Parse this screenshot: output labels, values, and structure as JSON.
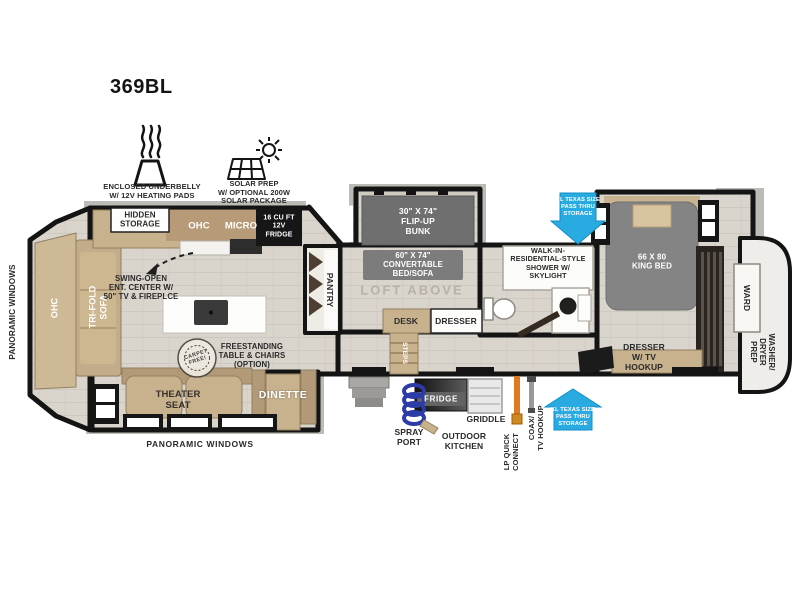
{
  "title": "369BL",
  "colors": {
    "wall": "#141414",
    "floor": "#d9d4cc",
    "cabinet_tan": "#c8b28e",
    "accent_cyan": "#29abe2",
    "lp_orange": "#e0791f",
    "spray_blue": "#2c3ba6"
  },
  "badges": {
    "underbelly_label": "ENCLOSED UNDERBELLY\nW/ 12V HEATING PADS",
    "solar_label": "SOLAR PREP\nW/ OPTIONAL 200W\nSOLAR PACKAGE"
  },
  "exterior": {
    "panoramic_front": "PANORAMIC WINDOWS",
    "panoramic_bottom": "PANORAMIC WINDOWS",
    "pass_thru_top": "XL TEXAS SIZE\nPASS THRU\nSTORAGE",
    "pass_thru_bottom": "XL TEXAS SIZE\nPASS THRU\nSTORAGE"
  },
  "outdoor": {
    "spray_port": "SPRAY\nPORT",
    "fridge": "FRIDGE",
    "griddle": "GRIDDLE",
    "kitchen": "OUTDOOR\nKITCHEN",
    "lp_quick_connect": "LP QUICK\nCONNECT",
    "coax_tv_hookup": "COAX/\nTV HOOKUP"
  },
  "living": {
    "ohc_front": "OHC",
    "tri_fold_sofa": "TRI-FOLD\nSOFA",
    "hidden_storage": "HIDDEN\nSTORAGE",
    "ohc": "OHC",
    "micro": "MICRO",
    "fridge": "16 CU FT\n12V\nFRIDGE",
    "ent_center": "SWING-OPEN\nENT. CENTER W/\n50\" TV & FIREPLCE",
    "carpet_free": "CARPET\nFREE!",
    "freestanding": "FREESTANDING\nTABLE & CHAIRS\n(OPTION)",
    "theater_seat": "THEATER\nSEAT",
    "dinette": "DINETTE",
    "pantry": "PANTRY",
    "steps": "STEPS"
  },
  "bunk": {
    "flip_up": "30\" X 74\"\nFLIP-UP\nBUNK",
    "convertible": "60\" X 74\"\nCONVERTABLE\nBED/SOFA",
    "loft_above": "LOFT ABOVE",
    "desk": "DESK",
    "dresser": "DRESSER"
  },
  "bath": {
    "shower": "WALK-IN-\nRESIDENTIAL-STYLE\nSHOWER W/\nSKYLIGHT"
  },
  "bedroom": {
    "king_bed": "66 X 80\nKING BED",
    "dresser_tv": "DRESSER\nW/ TV\nHOOKUP",
    "ward": "WARD",
    "washer_dryer": "WASHER/\nDRYER\nPREP"
  }
}
